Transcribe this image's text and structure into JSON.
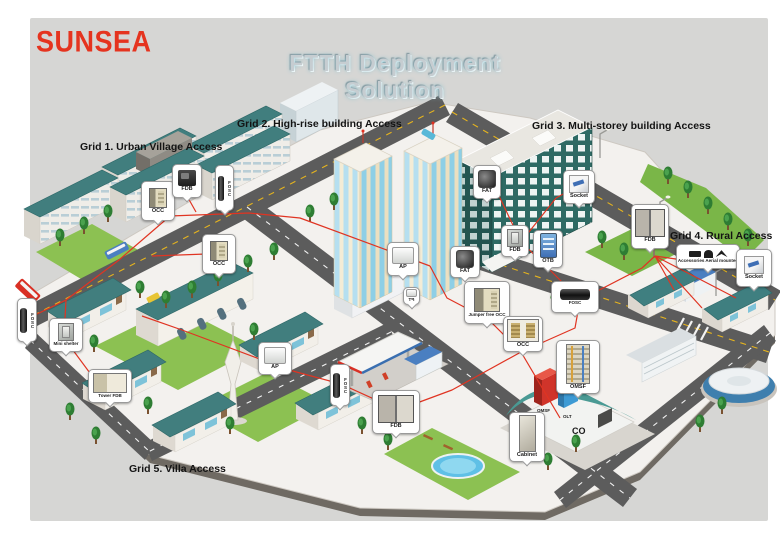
{
  "page": {
    "logo": "SUNSEA",
    "title": "FTTH Deployment Solution",
    "background": "#d6d6d4"
  },
  "grids": [
    {
      "label": "Grid 1. Urban Village Access"
    },
    {
      "label": "Grid 2. High-rise building Access"
    },
    {
      "label": "Grid 3. Multi-storey building Access"
    },
    {
      "label": "Grid 4. Rural Access"
    },
    {
      "label": "Grid 5. Villa Access"
    }
  ],
  "callouts": [
    {
      "label": "OCC",
      "icon": "open-cabinet"
    },
    {
      "label": "FDB",
      "icon": "dark-device"
    },
    {
      "label": "FOSC",
      "icon": "splice-closure-vertical"
    },
    {
      "label": "OCC",
      "icon": "open-cabinet"
    },
    {
      "label": "AP",
      "icon": "light-device"
    },
    {
      "label": "FAT",
      "icon": "dark-terminal"
    },
    {
      "label": "TB",
      "icon": "light-device"
    },
    {
      "label": "Jumper free OCC",
      "icon": "open-cabinet"
    },
    {
      "label": "OCC",
      "icon": "double-frame-cabinet"
    },
    {
      "label": "FDB",
      "icon": "cabinet"
    },
    {
      "label": "OTB",
      "icon": "blue-terminal-box"
    },
    {
      "label": "FAT",
      "icon": "dark-terminal"
    },
    {
      "label": "Socket",
      "icon": "socket"
    },
    {
      "label": "FOSC",
      "icon": "splice-closure-horizontal"
    },
    {
      "label": "FDB",
      "icon": "double-door-cabinet"
    },
    {
      "label": "Accessories Aerial mounted",
      "icon": "aerial-hardware"
    },
    {
      "label": "Socket",
      "icon": "socket"
    },
    {
      "label": "FOSC",
      "icon": "splice-closure-vertical"
    },
    {
      "label": "Mini shelter",
      "icon": "cabinet"
    },
    {
      "label": "Tower FDB",
      "icon": "wide-cabinet"
    },
    {
      "label": "AP",
      "icon": "light-device"
    },
    {
      "label": "FOSC",
      "icon": "splice-closure-vertical"
    },
    {
      "label": "FDB",
      "icon": "double-door-cabinet"
    },
    {
      "label": "Cabinet",
      "icon": "tall-cabinet"
    },
    {
      "label": "OMSF",
      "icon": "fiber-rack"
    }
  ],
  "co_site": {
    "omsf": "OMSF",
    "olt": "OLT",
    "co": "CO"
  },
  "colors": {
    "logo_red": "#e5341f",
    "fiber_red": "#e03422",
    "roof_teal": "#3f7f80",
    "canvas_gray": "#d6d6d4"
  }
}
